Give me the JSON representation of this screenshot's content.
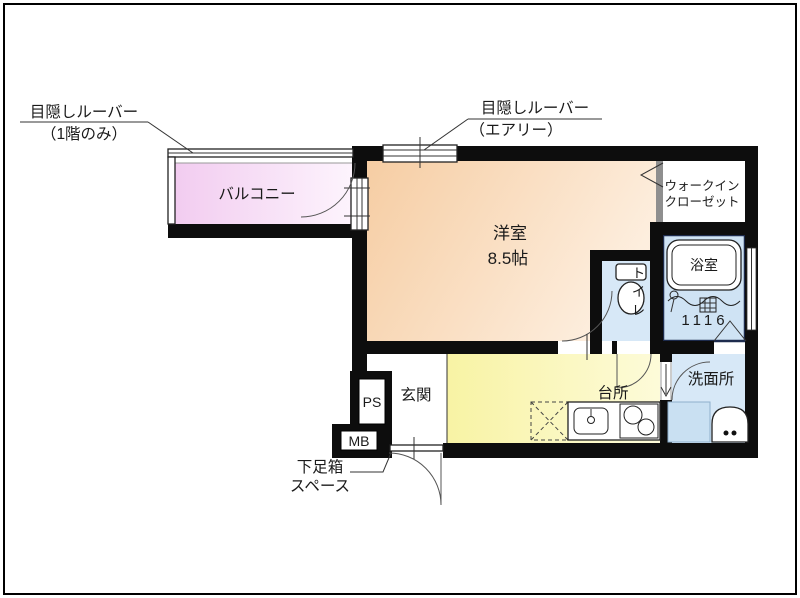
{
  "labels": {
    "louver_left_line1": "目隠しルーバー",
    "louver_left_line2": "（1階のみ）",
    "louver_top_line1": "目隠しルーバー",
    "louver_top_line2": "（エアリー）",
    "balcony": "バルコニー",
    "bedroom": "洋室",
    "bedroom_size": "8.5帖",
    "wic_line1": "ウォークイン",
    "wic_line2": "クローゼット",
    "bath": "浴室",
    "bath_dimensions": "1116",
    "toilet": "トイレ",
    "washroom": "洗面所",
    "kitchen": "台所",
    "entrance": "玄関",
    "pipe_space": "PS",
    "meter_box": "MB",
    "shoebox_line1": "下足箱",
    "shoebox_line2": "スペース"
  },
  "colors": {
    "wall": "#0d0d0d",
    "text": "#1a1a1a",
    "balcony1": "#f2ccf0",
    "balcony2": "#fdf4fd",
    "room1": "#f6cda3",
    "room2": "#fdeede",
    "kitchen1": "#f8f3a4",
    "kitchen2": "#fdfbd9",
    "water": "#d7e8f7",
    "water2": "#cfe3f4",
    "bathframe": "#1d2b4d"
  }
}
